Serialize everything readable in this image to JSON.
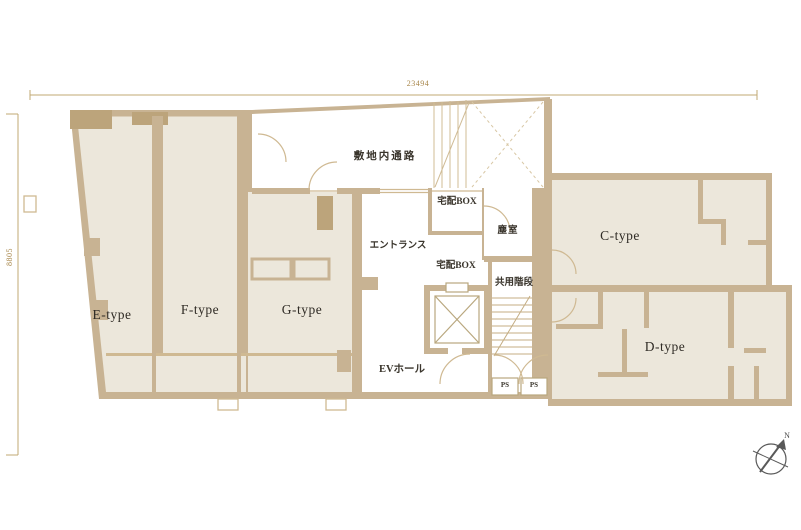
{
  "dimensions": {
    "top": "23494",
    "left": "8805"
  },
  "common_labels": {
    "site_passage": "敷地内通路",
    "delivery_box_room": "宅配BOX",
    "trash_room": "塵室",
    "entrance": "エントランス",
    "delivery_box": "宅配BOX",
    "shared_stairs": "共用階段",
    "ev_hall": "EVホール",
    "ps_left": "PS",
    "ps_right": "PS"
  },
  "units": [
    {
      "id": "e-type",
      "label": "E-type"
    },
    {
      "id": "f-type",
      "label": "F-type"
    },
    {
      "id": "g-type",
      "label": "G-type"
    },
    {
      "id": "c-type",
      "label": "C-type"
    },
    {
      "id": "d-type",
      "label": "D-type"
    }
  ],
  "compass": {
    "north": "N"
  },
  "colors": {
    "wall": "#c8b393",
    "wall_dark": "#bca47b",
    "room_fill": "#ece7db",
    "thin_line": "#cfb992",
    "dimension": "#c2a873",
    "dimension_text": "#a8874b",
    "label_text": "#3a352c"
  }
}
